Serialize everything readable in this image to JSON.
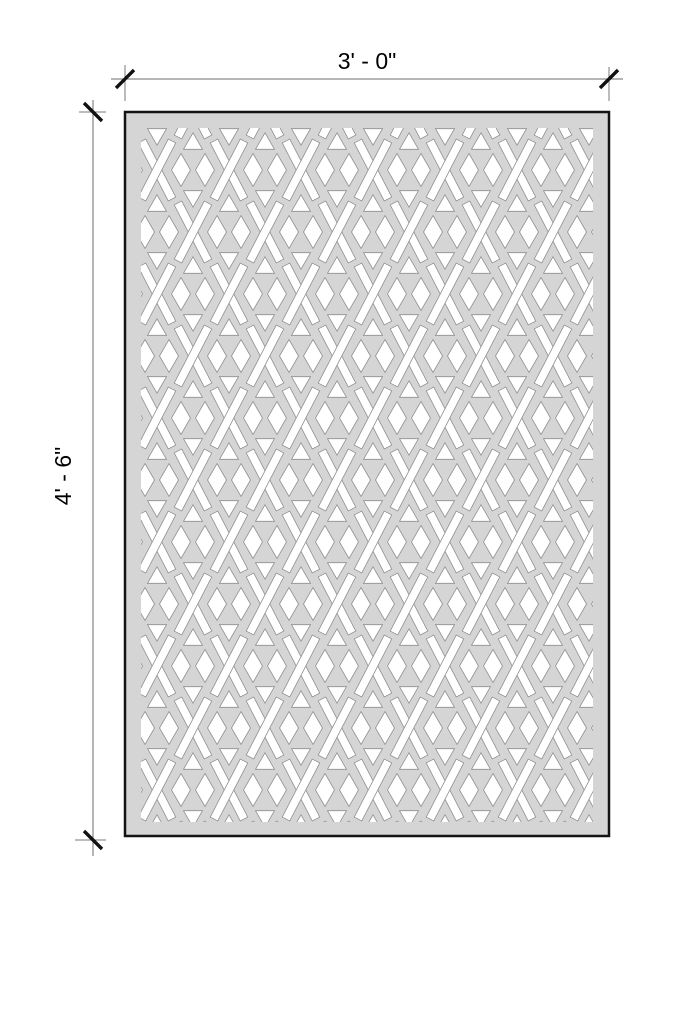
{
  "drawing": {
    "type": "panel-elevation-drawing",
    "pattern_name": "diamond-lattice-with-x-motifs",
    "dimensions": {
      "width": {
        "label": "3' - 0\""
      },
      "height": {
        "label": "4' - 6\""
      }
    },
    "colors": {
      "background": "#ffffff",
      "panel_fill": "#d5d5d5",
      "cutout": "#ffffff",
      "cutout_outline": "#8f8f8f",
      "panel_border": "#141414",
      "dimension_line": "#6e6e6e",
      "tick": "#111111",
      "text": "#000000"
    }
  }
}
